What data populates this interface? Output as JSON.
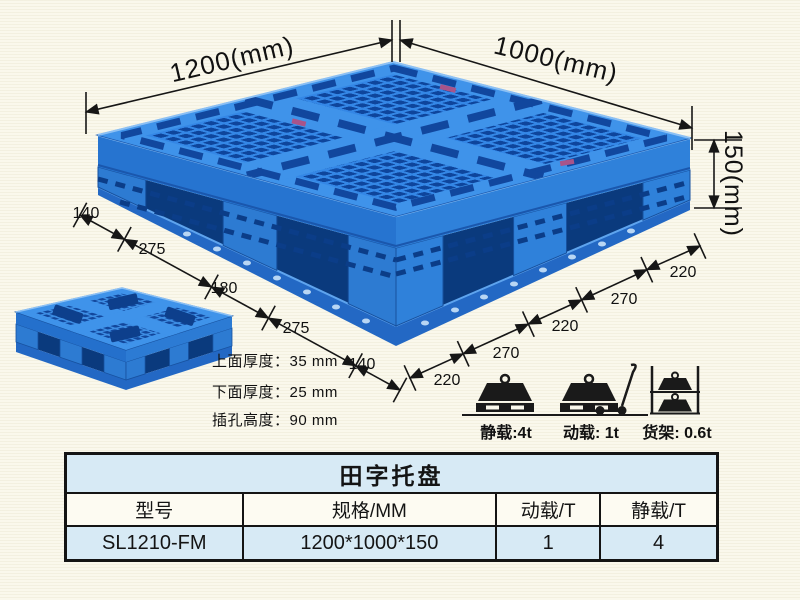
{
  "diagram": {
    "width_label": "1200(mm)",
    "depth_label": "1000(mm)",
    "height_label": "150(mm)",
    "left_chain": [
      "140",
      "275",
      "180",
      "275",
      "140"
    ],
    "right_chain": [
      "220",
      "270",
      "220",
      "270",
      "220"
    ],
    "notes": [
      "上面厚度：35 mm",
      "下面厚度：25 mm",
      "插孔高度：90 mm"
    ],
    "load_ratings": [
      {
        "icon": "static-load-icon",
        "caption": "静载:4t"
      },
      {
        "icon": "dynamic-load-icon",
        "caption": "动载: 1t"
      },
      {
        "icon": "rack-load-icon",
        "caption": "货架: 0.6t"
      }
    ],
    "colors": {
      "pallet_rib_blue": "#3487e6",
      "pallet_hole_blue": "#0e459c",
      "pallet_runway_blue": "#3f93ea",
      "annotation_black": "#161616",
      "table_band_blue": "#d7eaf5"
    }
  },
  "spec_table": {
    "title": "田字托盘",
    "headers": [
      "型号",
      "规格/MM",
      "动载/T",
      "静载/T"
    ],
    "rows": [
      [
        "SL1210-FM",
        "1200*1000*150",
        "1",
        "4"
      ]
    ]
  }
}
